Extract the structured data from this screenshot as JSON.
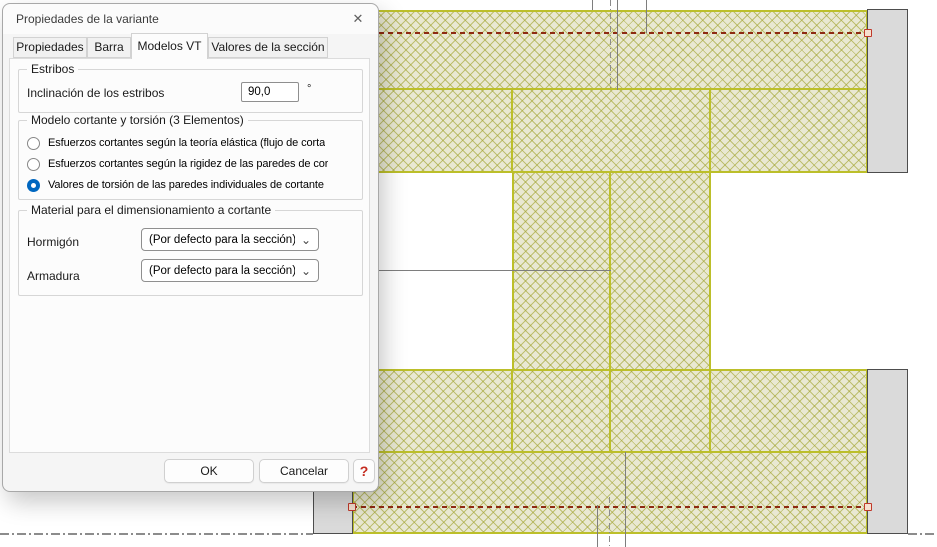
{
  "window": {
    "title": "Propiedades de la variante",
    "icons": {
      "close": "✕"
    }
  },
  "tabs": [
    {
      "label": "Propiedades",
      "active": false
    },
    {
      "label": "Barra",
      "active": false
    },
    {
      "label": "Modelos VT",
      "active": true
    },
    {
      "label": "Valores de la sección",
      "active": false
    }
  ],
  "estribos": {
    "legend": "Estribos",
    "label": "Inclinación de los estribos",
    "value": "90,0",
    "unit": "°"
  },
  "modelo_vt": {
    "legend": "Modelo cortante y torsión (3 Elementos)",
    "options": [
      {
        "label": "Esfuerzos cortantes según la teoría elástica (flujo de corta",
        "selected": false
      },
      {
        "label": "Esfuerzos cortantes según la rigidez de las paredes de cor",
        "selected": false
      },
      {
        "label": "Valores de torsión de las paredes individuales de cortante",
        "selected": true
      }
    ]
  },
  "material": {
    "legend": "Material para el dimensionamiento a cortante",
    "rows": [
      {
        "label": "Hormigón",
        "value": "(Por defecto para la sección)"
      },
      {
        "label": "Armadura",
        "value": "(Por defecto para la sección)"
      }
    ],
    "icons": {
      "dropdown": "⌄"
    }
  },
  "footer": {
    "ok": "OK",
    "cancel": "Cancelar",
    "help": "?"
  },
  "drawing": {
    "description": "Hatched concrete cross-section (shear walls) with end plates, red torsion axes and gray dimension lines",
    "colors": {
      "hatch_bg": "#e9e8d2",
      "hatch_line": "#a3a534",
      "boundary": "#bcbf2a",
      "plate_fill": "#dadada",
      "plate_border": "#4d4d4d",
      "axis_red": "#8e2a12",
      "measure_gray": "#7e7e7e",
      "selected_accent": "#0067c0"
    }
  }
}
